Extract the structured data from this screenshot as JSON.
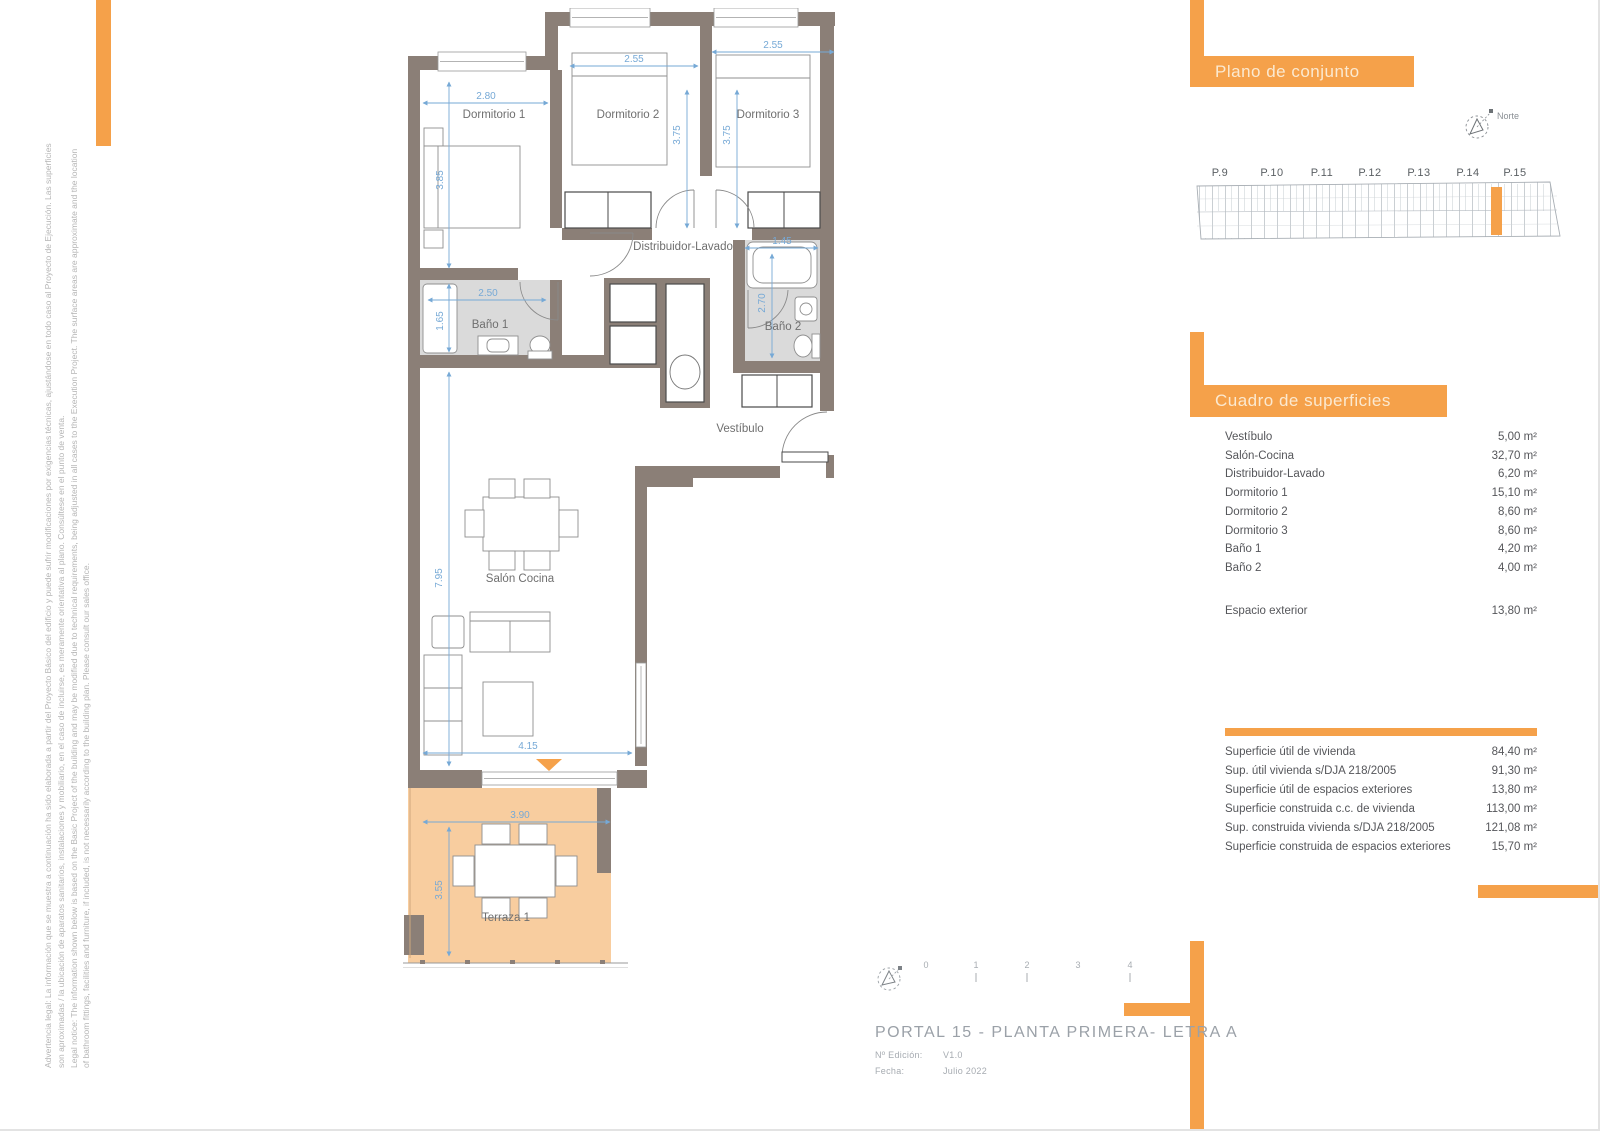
{
  "colors": {
    "accent_orange": "#F5A14A",
    "wall_taupe": "#8B7F77",
    "terrace_fill": "#F8CD9F",
    "bath_floor_gray": "#DADADA",
    "dimension_blue": "#76A9D6"
  },
  "plan": {
    "rooms": {
      "dormitorio1": "Dormitorio 1",
      "dormitorio2": "Dormitorio 2",
      "dormitorio3": "Dormitorio 3",
      "distribuidor": "Distribuidor-Lavado",
      "bano1": "Baño 1",
      "bano2": "Baño 2",
      "vestibulo": "Vestíbulo",
      "salon": "Salón Cocina",
      "terraza": "Terraza 1"
    },
    "dims": {
      "dorm1_w": "2.80",
      "dorm1_h": "3.85",
      "dorm2_w": "2.55",
      "dorm2_h": "3.75",
      "dorm3_w": "2.55",
      "dorm3_h": "3.75",
      "bano1_w": "2.50",
      "bano1_h": "1.65",
      "bano2_w": "1.45",
      "bano2_h": "2.70",
      "salon_h": "7.95",
      "salon_w": "4.15",
      "terraza_w": "3.90",
      "terraza_h": "3.55"
    }
  },
  "site_plan": {
    "title": "Plano de conjunto",
    "north_label": "Norte",
    "portals": [
      "P.9",
      "P.10",
      "P.11",
      "P.12",
      "P.13",
      "P.14",
      "P.15"
    ]
  },
  "surfaces": {
    "title": "Cuadro de superficies",
    "rows": [
      {
        "label": "Vestíbulo",
        "value": "5,00 m²"
      },
      {
        "label": "Salón-Cocina",
        "value": "32,70 m²"
      },
      {
        "label": "Distribuidor-Lavado",
        "value": "6,20 m²"
      },
      {
        "label": "Dormitorio 1",
        "value": "15,10 m²"
      },
      {
        "label": "Dormitorio 2",
        "value": "8,60 m²"
      },
      {
        "label": "Dormitorio 3",
        "value": "8,60 m²"
      },
      {
        "label": "Baño 1",
        "value": "4,20 m²"
      },
      {
        "label": "Baño 2",
        "value": "4,00 m²"
      }
    ],
    "exterior": {
      "label": "Espacio exterior",
      "value": "13,80 m²"
    },
    "summary": [
      {
        "label": "Superficie útil de vivienda",
        "value": "84,40 m²"
      },
      {
        "label": "Sup. útil vivienda s/DJA 218/2005",
        "value": "91,30 m²"
      },
      {
        "label": "Superficie útil de espacios exteriores",
        "value": "13,80 m²"
      },
      {
        "label": "Superficie construida c.c. de vivienda",
        "value": "113,00 m²"
      },
      {
        "label": "Sup. construida vivienda s/DJA 218/2005",
        "value": "121,08 m²"
      },
      {
        "label": "Superficie construida de espacios exteriores",
        "value": "15,70 m²"
      }
    ]
  },
  "title_block": {
    "title": "PORTAL 15 - PLANTA PRIMERA- LETRA A",
    "edition_label": "Nº Edición:",
    "edition_value": "V1.0",
    "date_label": "Fecha:",
    "date_value": "Julio 2022",
    "scale": [
      "0",
      "1",
      "2",
      "3",
      "4"
    ]
  },
  "disclaimer": {
    "line1": "Advertencia legal: La información que se muestra a continuación ha sido elaborada a partir del Proyecto Básico del edificio y puede sufrir modificaciones por exigencias técnicas, ajustándose en todo caso al Proyecto de Ejecución. Las superficies",
    "line2": "son aproximadas / la ubicación de aparatos sanitarios, instalaciones y mobiliario, en el caso de incluirse, es meramente orientativa al plano. Consúltese en el punto de venta.",
    "line3": "Legal notice: The information shown below is based on the Basic Project of the building and may be modified due to technical requirements, being adjusted in all cases to the Execution Project. The surface areas are approximate and the location",
    "line4": "of bathroom fittings, facilities and furniture, if included, is not necessarily according to the building plan. Please consult our sales office."
  }
}
